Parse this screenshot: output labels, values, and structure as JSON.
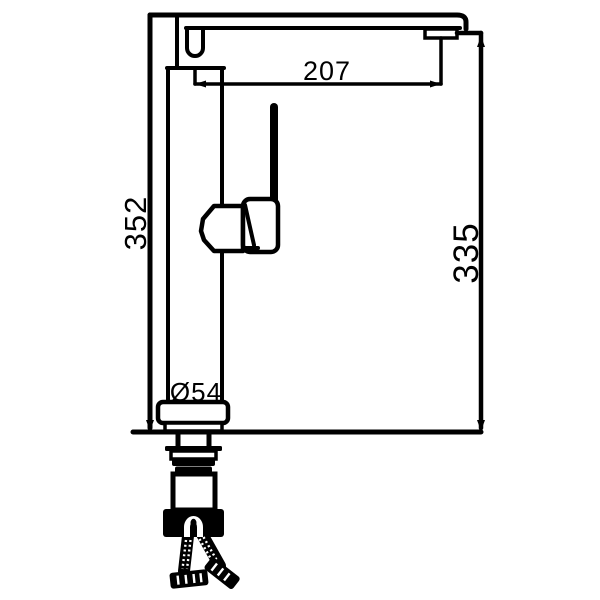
{
  "drawing": {
    "title": "single-handle tall faucet side-elevation technical drawing",
    "background": "#ffffff",
    "line_color": "#000000",
    "labels": {
      "spout_reach": "207",
      "overall_height": "352",
      "outlet_height": "335",
      "base_diameter": "Ø54"
    }
  }
}
